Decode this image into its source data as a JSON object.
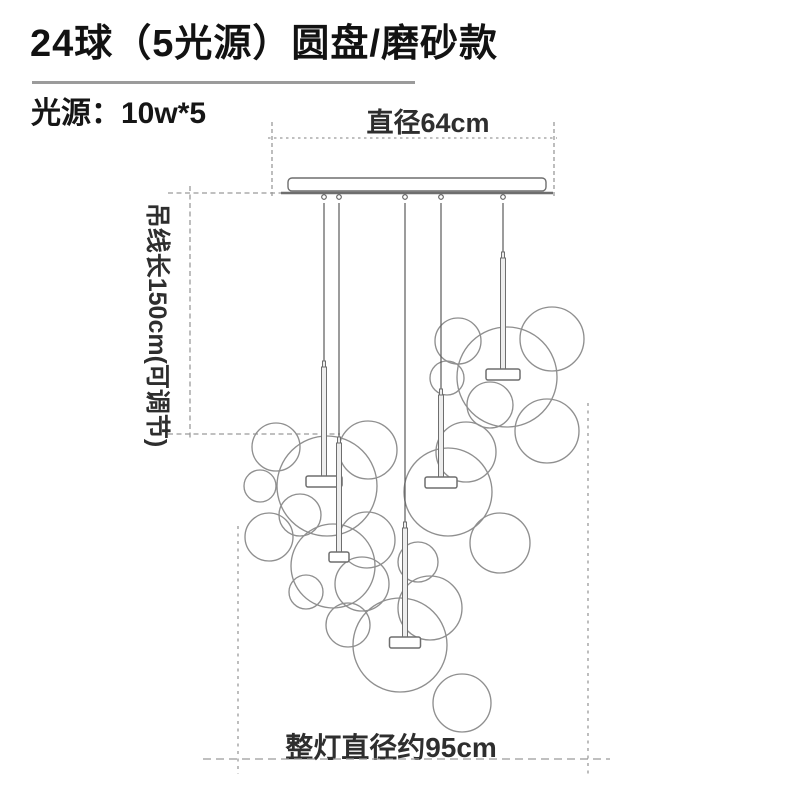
{
  "header": {
    "title": "24球（5光源）圆盘/磨砂款",
    "spec": "光源：10w*5"
  },
  "dims": {
    "top_label": "直径64cm",
    "left_label": "吊线长150cm(可调节)",
    "bottom_label": "整灯直径约95cm"
  },
  "colors": {
    "bubble_line": "#8f8f8f",
    "hardware_line": "#6e6e6e",
    "wire_line": "#5a5a5a",
    "dim_line": "#9a9a9a",
    "tube_fill": "#ededed",
    "plate_fill": "#ffffff"
  },
  "diagram": {
    "canopy": {
      "x": 288,
      "y": 178,
      "width": 258,
      "height": 13,
      "corner_radius": 4,
      "bar_x1": 281,
      "bar_x2": 553,
      "bar_y": 193
    },
    "pendants": [
      {
        "x": 324,
        "wire_top": 197,
        "tube_top": 367,
        "plate_y": 476,
        "plate_w": 36,
        "plate_h": 11
      },
      {
        "x": 339,
        "wire_top": 197,
        "tube_top": 443,
        "plate_y": 552,
        "plate_w": 20,
        "plate_h": 10
      },
      {
        "x": 405,
        "wire_top": 197,
        "tube_top": 528,
        "plate_y": 637,
        "plate_w": 31,
        "plate_h": 11
      },
      {
        "x": 441,
        "wire_top": 197,
        "tube_top": 395,
        "plate_y": 477,
        "plate_w": 32,
        "plate_h": 11
      },
      {
        "x": 503,
        "wire_top": 197,
        "tube_top": 258,
        "plate_y": 369,
        "plate_w": 34,
        "plate_h": 11
      }
    ],
    "bubbles": [
      {
        "cx": 458,
        "cy": 341,
        "r": 23
      },
      {
        "cx": 552,
        "cy": 339,
        "r": 32
      },
      {
        "cx": 507,
        "cy": 377,
        "r": 50
      },
      {
        "cx": 447,
        "cy": 378,
        "r": 17
      },
      {
        "cx": 490,
        "cy": 405,
        "r": 23
      },
      {
        "cx": 547,
        "cy": 431,
        "r": 32
      },
      {
        "cx": 466,
        "cy": 452,
        "r": 30
      },
      {
        "cx": 448,
        "cy": 492,
        "r": 44
      },
      {
        "cx": 500,
        "cy": 543,
        "r": 30
      },
      {
        "cx": 276,
        "cy": 447,
        "r": 24
      },
      {
        "cx": 260,
        "cy": 486,
        "r": 16
      },
      {
        "cx": 327,
        "cy": 486,
        "r": 50
      },
      {
        "cx": 300,
        "cy": 515,
        "r": 21
      },
      {
        "cx": 269,
        "cy": 537,
        "r": 24
      },
      {
        "cx": 333,
        "cy": 566,
        "r": 42
      },
      {
        "cx": 368,
        "cy": 450,
        "r": 29
      },
      {
        "cx": 367,
        "cy": 540,
        "r": 28
      },
      {
        "cx": 362,
        "cy": 584,
        "r": 27
      },
      {
        "cx": 348,
        "cy": 625,
        "r": 22
      },
      {
        "cx": 400,
        "cy": 645,
        "r": 47
      },
      {
        "cx": 430,
        "cy": 608,
        "r": 32
      },
      {
        "cx": 462,
        "cy": 703,
        "r": 29
      },
      {
        "cx": 306,
        "cy": 592,
        "r": 17
      },
      {
        "cx": 418,
        "cy": 562,
        "r": 20
      }
    ],
    "dim_top": {
      "dot_y": 138,
      "x1": 268,
      "x2": 557,
      "tick_left_x": 272,
      "tick_right_x": 554,
      "tick_y1": 122,
      "tick_y2": 197
    },
    "dim_left": {
      "x": 190,
      "y1": 186,
      "y2": 438,
      "tick_top_y": 193,
      "tick_top_x1": 168,
      "tick_top_x2": 298,
      "tick_bot_y": 434,
      "tick_bot_x1": 168,
      "tick_bot_x2": 340
    },
    "dim_bottom": {
      "y": 759,
      "x1": 203,
      "x2": 610,
      "tick_left_x": 238,
      "tick_left_y1": 526,
      "tick_right_x": 588,
      "tick_right_y1": 403,
      "tick_y2": 774
    }
  }
}
